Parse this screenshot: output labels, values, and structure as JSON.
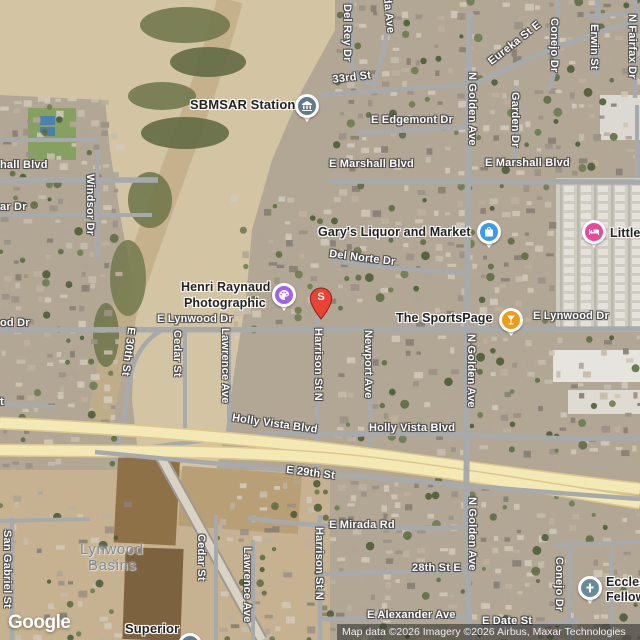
{
  "map": {
    "street_labels": [
      {
        "text": "Del Rey Dr",
        "x": 353,
        "y": 4,
        "rot": 90
      },
      {
        "text": "eda Ave",
        "x": 392,
        "y": -10,
        "rot": 84
      },
      {
        "text": "33rd St",
        "x": 332,
        "y": 74,
        "rot": -7
      },
      {
        "text": "Eureka St E",
        "x": 486,
        "y": 58,
        "rot": -38
      },
      {
        "text": "Conejo Dr",
        "x": 560,
        "y": 18,
        "rot": 90
      },
      {
        "text": "Erwin St",
        "x": 600,
        "y": 24,
        "rot": 90
      },
      {
        "text": "N Fairfax Dr",
        "x": 638,
        "y": 14,
        "rot": 90
      },
      {
        "text": "E Edgemont Dr",
        "x": 371,
        "y": 114,
        "rot": 0
      },
      {
        "text": "N Golden Ave",
        "x": 478,
        "y": 72,
        "rot": 90
      },
      {
        "text": "Garden Dr",
        "x": 521,
        "y": 92,
        "rot": 90
      },
      {
        "text": "E Marshall Blvd",
        "x": 329,
        "y": 158,
        "rot": 0
      },
      {
        "text": "E Marshall Blvd",
        "x": 485,
        "y": 157,
        "rot": 0
      },
      {
        "text": "hall Blvd",
        "x": 0,
        "y": 159,
        "rot": 0
      },
      {
        "text": "ar Dr",
        "x": 0,
        "y": 201,
        "rot": 0
      },
      {
        "text": "Windsor Dr",
        "x": 96,
        "y": 174,
        "rot": 90
      },
      {
        "text": "Del Norte Dr",
        "x": 330,
        "y": 248,
        "rot": 7
      },
      {
        "text": "E Lynwood Dr",
        "x": 157,
        "y": 313,
        "rot": 0
      },
      {
        "text": "od Dr",
        "x": 0,
        "y": 317,
        "rot": 0
      },
      {
        "text": "E Lynwood Dr",
        "x": 533,
        "y": 310,
        "rot": 0
      },
      {
        "text": "E 30th St",
        "x": 137,
        "y": 328,
        "rot": 97
      },
      {
        "text": "Cedar St",
        "x": 183,
        "y": 330,
        "rot": 90
      },
      {
        "text": "Lawrence Ave",
        "x": 231,
        "y": 328,
        "rot": 90
      },
      {
        "text": "Harrison St N",
        "x": 324,
        "y": 328,
        "rot": 90
      },
      {
        "text": "Newport Ave",
        "x": 374,
        "y": 330,
        "rot": 90
      },
      {
        "text": "N Golden Ave",
        "x": 477,
        "y": 334,
        "rot": 90
      },
      {
        "text": "Holly Vista Blvd",
        "x": 233,
        "y": 412,
        "rot": 8
      },
      {
        "text": "Holly Vista Blvd",
        "x": 369,
        "y": 422,
        "rot": 0
      },
      {
        "text": "E 29th St",
        "x": 287,
        "y": 464,
        "rot": 7
      },
      {
        "text": "t",
        "x": 0,
        "y": 396,
        "rot": 0
      },
      {
        "text": "San Gabriel St",
        "x": 13,
        "y": 530,
        "rot": 90
      },
      {
        "text": "Cedar St",
        "x": 207,
        "y": 534,
        "rot": 90
      },
      {
        "text": "Lawrence Ave",
        "x": 253,
        "y": 547,
        "rot": 90
      },
      {
        "text": "Harrison St N",
        "x": 325,
        "y": 527,
        "rot": 90
      },
      {
        "text": "N Golden Ave",
        "x": 478,
        "y": 497,
        "rot": 90
      },
      {
        "text": "E Mirada Rd",
        "x": 329,
        "y": 519,
        "rot": 0
      },
      {
        "text": "28th St E",
        "x": 412,
        "y": 562,
        "rot": 0
      },
      {
        "text": "Conejo Dr",
        "x": 565,
        "y": 557,
        "rot": 90
      },
      {
        "text": "E Alexander Ave",
        "x": 367,
        "y": 609,
        "rot": 0
      },
      {
        "text": "E Date St",
        "x": 482,
        "y": 615,
        "rot": 0
      }
    ],
    "poi_labels": [
      {
        "text": "SBMSAR Station",
        "x": 190,
        "y": 97,
        "size": 13
      },
      {
        "text": "Gary's Liquor and Market",
        "x": 318,
        "y": 225,
        "size": 12.5
      },
      {
        "text": "Little",
        "x": 610,
        "y": 226,
        "size": 12.5
      },
      {
        "text": "Henri Raynaud",
        "x": 181,
        "y": 280,
        "size": 12.5
      },
      {
        "text": "Photographic",
        "x": 184,
        "y": 296,
        "size": 12.5
      },
      {
        "text": "The SportsPage",
        "x": 396,
        "y": 311,
        "size": 12.5
      },
      {
        "text": "Superior",
        "x": 125,
        "y": 621,
        "size": 13
      },
      {
        "text": "Ecclesia",
        "x": 606,
        "y": 575,
        "size": 12.5
      },
      {
        "text": "Fellowship",
        "x": 606,
        "y": 590,
        "size": 12.5
      }
    ],
    "area_labels": [
      {
        "text": "Lynwood",
        "x": 80,
        "y": 541
      },
      {
        "text": "Basins",
        "x": 88,
        "y": 557
      }
    ],
    "markers": [
      {
        "name": "station-civic-marker",
        "icon": "museum-icon",
        "x": 307,
        "y": 106,
        "color": "#5E7C8B"
      },
      {
        "name": "liquor-store-marker",
        "icon": "shopping-bag-icon",
        "x": 489,
        "y": 232,
        "color": "#3D9BE9"
      },
      {
        "name": "hotel-marker",
        "icon": "bed-icon",
        "x": 594,
        "y": 232,
        "color": "#E8499B"
      },
      {
        "name": "photographic-marker",
        "icon": "palette-icon",
        "x": 284,
        "y": 295,
        "color": "#A161F2"
      },
      {
        "name": "sports-bar-marker",
        "icon": "martini-icon",
        "x": 511,
        "y": 320,
        "color": "#F09B13"
      },
      {
        "name": "church-marker",
        "icon": "cross-icon",
        "x": 590,
        "y": 588,
        "color": "#688B9B"
      },
      {
        "name": "superior-marker",
        "icon": "museum-icon",
        "x": 190,
        "y": 645,
        "color": "#5E7C8B"
      }
    ],
    "pin": {
      "letter": "S",
      "x": 321,
      "y": 319,
      "color": "#E94335"
    }
  },
  "colors": {
    "road": "#a7aaad",
    "freeway_fill": "#f4e8b5",
    "freeway_casing": "#dcc88e",
    "street_label": "#ffffff",
    "poi_label": "#222222",
    "area_label": "#7f8a95"
  },
  "attribution": {
    "logo": "Google",
    "text": "Map data ©2026 Imagery ©2026 Airbus, Maxar Technologies"
  }
}
